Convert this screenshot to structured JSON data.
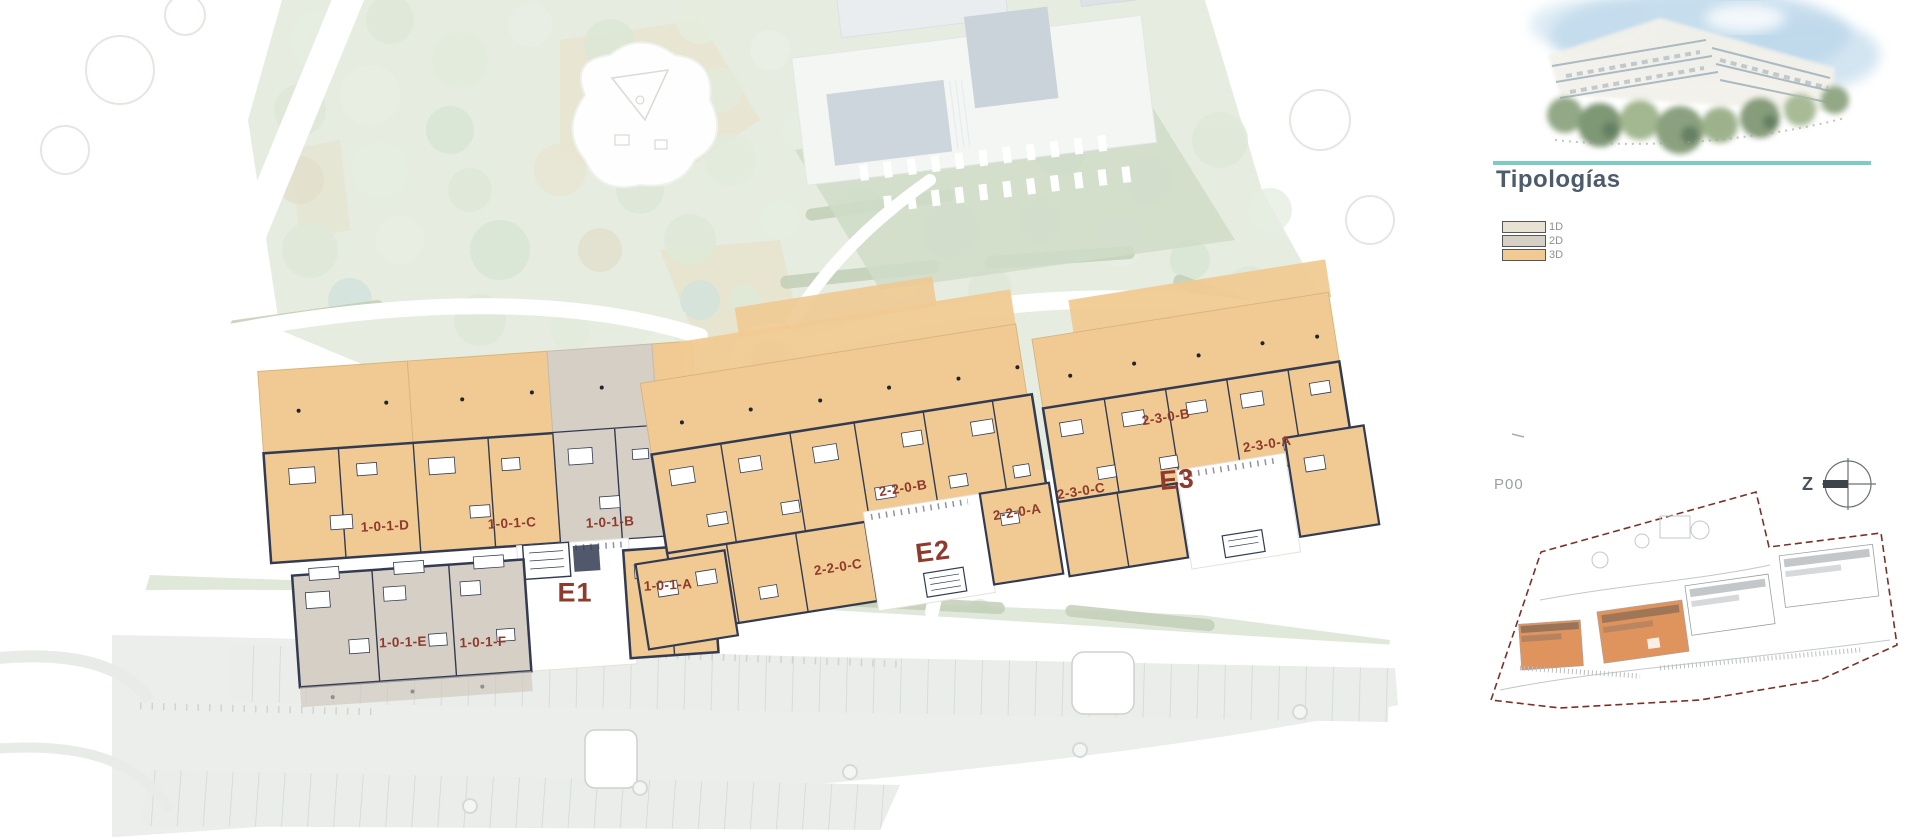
{
  "artwork": {
    "alt": "Watercolor rendering of terraced apartment building with gardens"
  },
  "legend": {
    "title": "Tipologías",
    "items": [
      {
        "label": "1D",
        "color": "#e7e2d1"
      },
      {
        "label": "2D",
        "color": "#d6cfc5"
      },
      {
        "label": "3D",
        "color": "#f0ca92"
      }
    ]
  },
  "plan": {
    "level_label": "P00",
    "north_label": "Z",
    "blocks": [
      {
        "label": "E1",
        "units": [
          "1-0-1-D",
          "1-0-1-C",
          "1-0-1-B",
          "1-0-1-A",
          "1-0-1-E",
          "1-0-1-F"
        ]
      },
      {
        "label": "E2",
        "units": [
          "2-2-0-B",
          "2-2-0-A",
          "2-2-0-C"
        ]
      },
      {
        "label": "E3",
        "units": [
          "2-3-0-C",
          "2-3-0-B",
          "2-3-0-A"
        ]
      }
    ]
  },
  "colors": {
    "accent_teal": "#7ecac5",
    "title_slate": "#4d5b6b",
    "unit_label_red": "#8e3a2c",
    "wall_navy": "#323b52",
    "typology_1d": "#e7e2d1",
    "typology_2d": "#d6cfc5",
    "typology_3d": "#f0ca92",
    "minimap_highlight_orange": "#dd8a50",
    "minimap_boundary_red": "#7c3128",
    "park_green": "#e6ecdf",
    "pool_water": "#ccd5dc"
  }
}
